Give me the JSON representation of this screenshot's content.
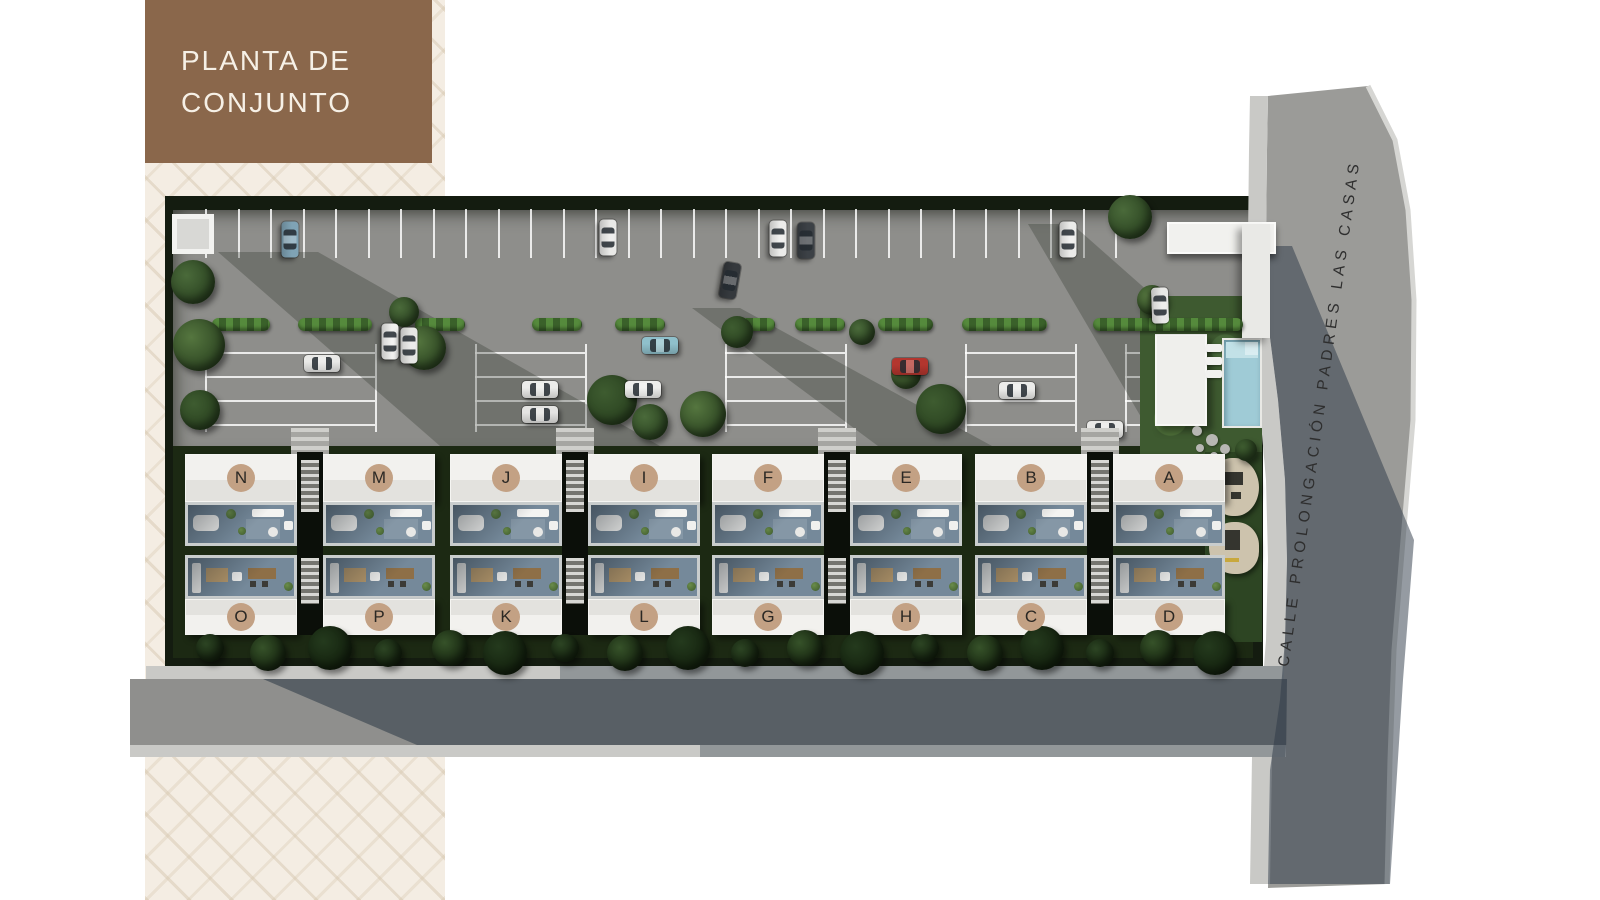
{
  "title": {
    "line1": "PLANTA DE",
    "line2": "CONJUNTO"
  },
  "street": {
    "name": "CALLE PROLONGACIÓN PADRES LAS CASAS"
  },
  "colors": {
    "title_bg": "#8a674b",
    "title_text": "#f6f0e6",
    "panel_bg": "#f4ede3",
    "asphalt": "#8e8e8b",
    "sidewalk": "#c9c9c6",
    "street": "#9b9b98",
    "shadow_blue": "rgba(44,56,69,0.5)",
    "hedge_border": "#141c10",
    "grass": "#3e5a30",
    "roof": "#f2f1ee",
    "terrace": "#75899a",
    "badge": "#c3a184",
    "badge_text": "#2b2824",
    "pool": "#9fcbd6",
    "tree_palette": [
      "#4a6a3a",
      "#55763f",
      "#3e5c30"
    ],
    "band_tree_palette": [
      "#2c4423",
      "#365229",
      "#243a1d"
    ]
  },
  "blocks": [
    {
      "x": 185,
      "top": [
        "N",
        "M"
      ],
      "bottom": [
        "O",
        "P"
      ]
    },
    {
      "x": 450,
      "top": [
        "J",
        "I"
      ],
      "bottom": [
        "K",
        "L"
      ]
    },
    {
      "x": 712,
      "top": [
        "F",
        "E"
      ],
      "bottom": [
        "G",
        "H"
      ]
    },
    {
      "x": 975,
      "top": [
        "B",
        "A"
      ],
      "bottom": [
        "C",
        "D"
      ]
    }
  ],
  "parking": {
    "top_row": {
      "x0": 205,
      "x1": 1115,
      "step": 32.5,
      "y": 209,
      "h": 49
    },
    "rows_y": [
      352,
      376,
      400,
      424
    ],
    "groups": [
      [
        205,
        375
      ],
      [
        475,
        585
      ],
      [
        725,
        845
      ],
      [
        965,
        1075
      ],
      [
        1125,
        1245
      ]
    ]
  },
  "hedges": [
    {
      "x": 212,
      "w": 58
    },
    {
      "x": 298,
      "w": 74
    },
    {
      "x": 415,
      "w": 50
    },
    {
      "x": 532,
      "w": 50
    },
    {
      "x": 615,
      "w": 50
    },
    {
      "x": 725,
      "w": 50
    },
    {
      "x": 795,
      "w": 50
    },
    {
      "x": 878,
      "w": 55
    },
    {
      "x": 962,
      "w": 85
    },
    {
      "x": 1093,
      "w": 150
    }
  ],
  "trees": [
    {
      "x": 193,
      "y": 282,
      "r": 22
    },
    {
      "x": 199,
      "y": 345,
      "r": 26
    },
    {
      "x": 200,
      "y": 410,
      "r": 20
    },
    {
      "x": 404,
      "y": 312,
      "r": 15
    },
    {
      "x": 424,
      "y": 348,
      "r": 22
    },
    {
      "x": 612,
      "y": 400,
      "r": 25
    },
    {
      "x": 650,
      "y": 422,
      "r": 18
    },
    {
      "x": 703,
      "y": 414,
      "r": 23
    },
    {
      "x": 737,
      "y": 332,
      "r": 16
    },
    {
      "x": 862,
      "y": 332,
      "r": 13
    },
    {
      "x": 906,
      "y": 374,
      "r": 15
    },
    {
      "x": 941,
      "y": 409,
      "r": 25
    },
    {
      "x": 1130,
      "y": 217,
      "r": 22
    },
    {
      "x": 1152,
      "y": 300,
      "r": 15
    },
    {
      "x": 1246,
      "y": 450,
      "r": 11
    }
  ],
  "band_trees": [
    {
      "x": 210
    },
    {
      "x": 268
    },
    {
      "x": 330
    },
    {
      "x": 388
    },
    {
      "x": 450
    },
    {
      "x": 505
    },
    {
      "x": 565
    },
    {
      "x": 625
    },
    {
      "x": 688
    },
    {
      "x": 745
    },
    {
      "x": 805
    },
    {
      "x": 862
    },
    {
      "x": 925
    },
    {
      "x": 985
    },
    {
      "x": 1042
    },
    {
      "x": 1100
    },
    {
      "x": 1158
    },
    {
      "x": 1215
    }
  ],
  "cars": [
    {
      "x": 290,
      "y": 240,
      "deg": 90,
      "color": "#7fa3b5"
    },
    {
      "x": 608,
      "y": 238,
      "deg": 90,
      "color": "#e9e9e7"
    },
    {
      "x": 778,
      "y": 239,
      "deg": 90,
      "color": "#ececea"
    },
    {
      "x": 806,
      "y": 241,
      "deg": 90,
      "color": "#3c4146"
    },
    {
      "x": 1068,
      "y": 240,
      "deg": 90,
      "color": "#ebebe9"
    },
    {
      "x": 730,
      "y": 281,
      "deg": 100,
      "color": "#35393d"
    },
    {
      "x": 1160,
      "y": 306,
      "deg": 88,
      "color": "#e8e8e6"
    },
    {
      "x": 322,
      "y": 364,
      "deg": 0,
      "color": "#e9e9e7"
    },
    {
      "x": 390,
      "y": 342,
      "deg": 90,
      "color": "#f0f0ee"
    },
    {
      "x": 409,
      "y": 346,
      "deg": 90,
      "color": "#e6e6e4"
    },
    {
      "x": 540,
      "y": 390,
      "deg": 0,
      "color": "#ececea"
    },
    {
      "x": 540,
      "y": 415,
      "deg": 0,
      "color": "#e4e4e2"
    },
    {
      "x": 660,
      "y": 346,
      "deg": 0,
      "color": "#8fc0cb"
    },
    {
      "x": 643,
      "y": 390,
      "deg": 0,
      "color": "#eeeeec"
    },
    {
      "x": 910,
      "y": 367,
      "deg": 0,
      "color": "#b3362e"
    },
    {
      "x": 1017,
      "y": 391,
      "deg": 0,
      "color": "#ececea"
    },
    {
      "x": 1105,
      "y": 430,
      "deg": 0,
      "color": "#e9e9e7"
    }
  ]
}
